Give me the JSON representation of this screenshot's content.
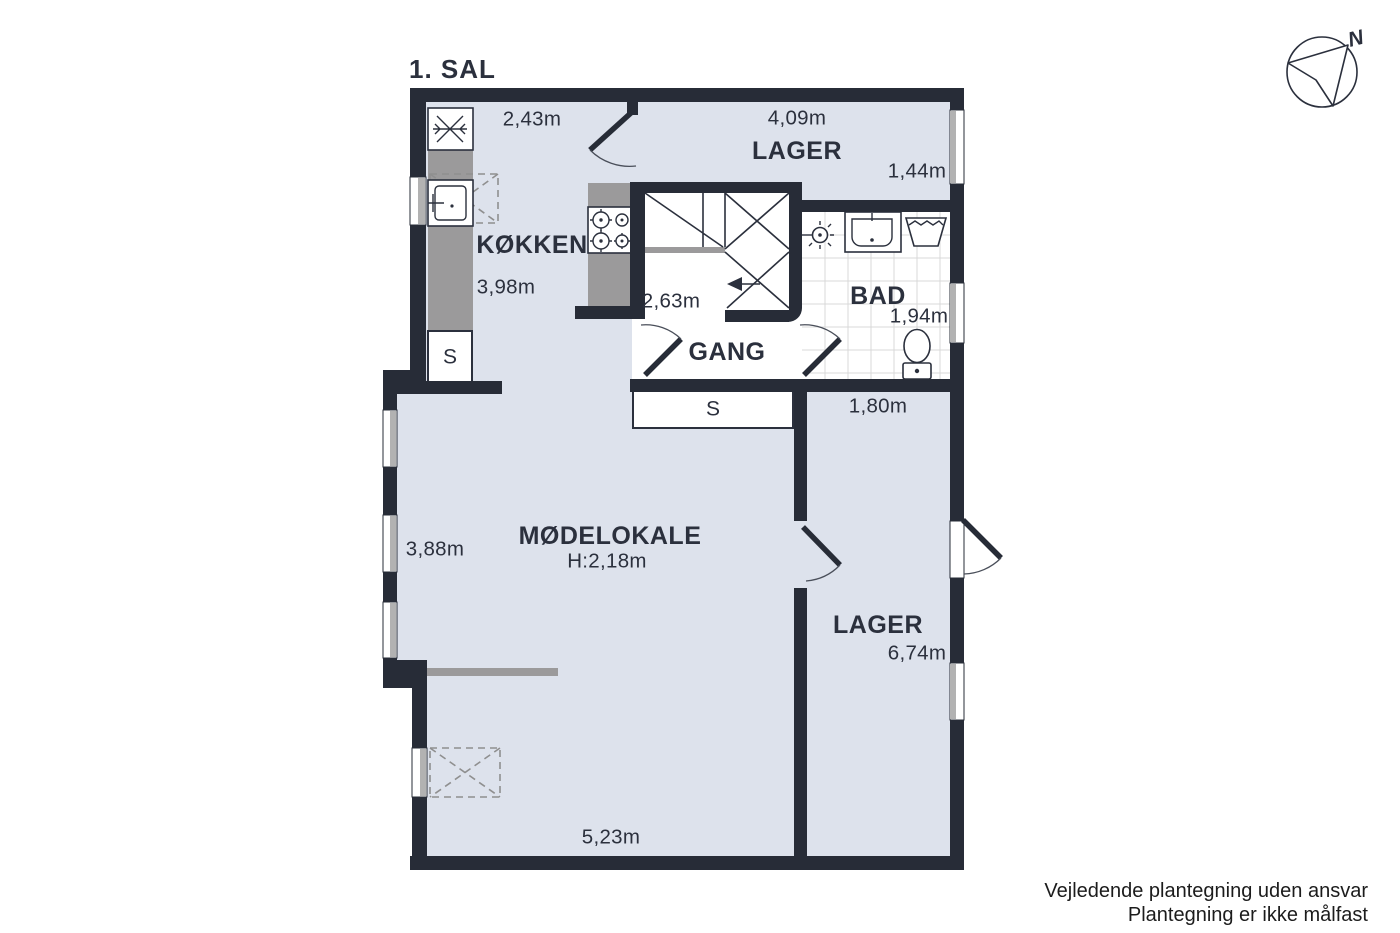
{
  "title": "1. SAL",
  "compass": {
    "north": "N"
  },
  "rooms": {
    "lager_top": {
      "label": "LAGER",
      "dim_width": "4,09m",
      "dim_depth": "1,44m"
    },
    "koekken": {
      "label": "KØKKEN",
      "dim_width": "2,43m",
      "dim_depth": "3,98m"
    },
    "gang": {
      "label": "GANG",
      "dim_width": "2,63m"
    },
    "bad": {
      "label": "BAD",
      "dim_width": "1,94m"
    },
    "moedelokale": {
      "label": "MØDELOKALE",
      "ceiling_height": "H:2,18m",
      "dim_depth": "3,88m",
      "dim_width": "5,23m"
    },
    "lager_bottom": {
      "label": "LAGER",
      "dim_depth": "6,74m",
      "dim_north_width": "1,80m"
    },
    "closet_kitchen": {
      "label": "S"
    },
    "closet_gang": {
      "label": "S"
    }
  },
  "footer": {
    "line1": "Vejledende plantegning uden ansvar",
    "line2": "Plantegning er ikke målfast"
  },
  "colors": {
    "wall": "#272c37",
    "floor": "#dde2ec",
    "counter": "#9b9a9b",
    "window": "#b2b2b2",
    "text": "#2b303d"
  }
}
